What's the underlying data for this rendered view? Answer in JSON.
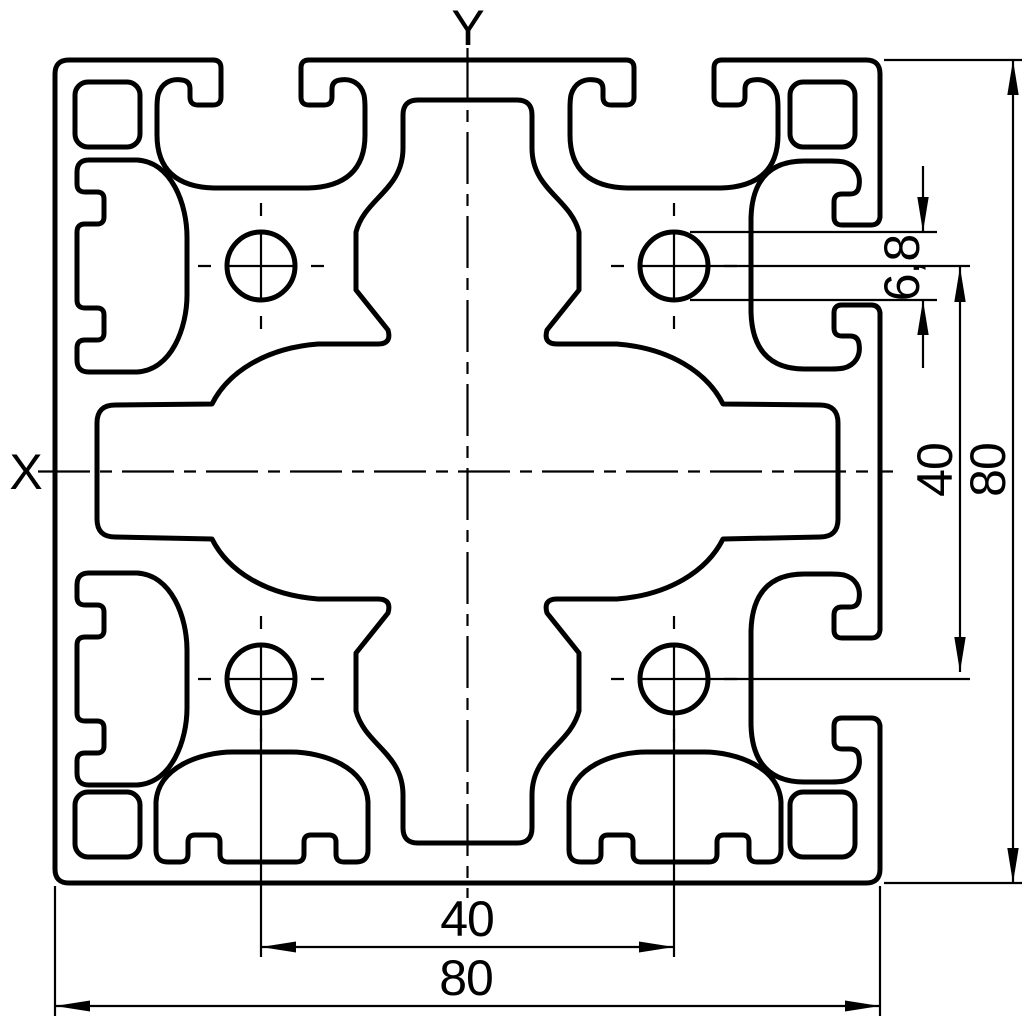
{
  "drawing": {
    "type": "technical-drawing-cross-section",
    "axis_labels": {
      "x": "X",
      "y": "Y"
    },
    "dimensions": {
      "bottom_hole_spacing": {
        "value": "40"
      },
      "bottom_overall_width": {
        "value": "80"
      },
      "right_hole_spacing": {
        "value": "40"
      },
      "right_overall_height": {
        "value": "80"
      },
      "core_hole_diameter": {
        "value": "6,8"
      }
    },
    "colors": {
      "line": "#000000",
      "background": "#ffffff"
    }
  }
}
